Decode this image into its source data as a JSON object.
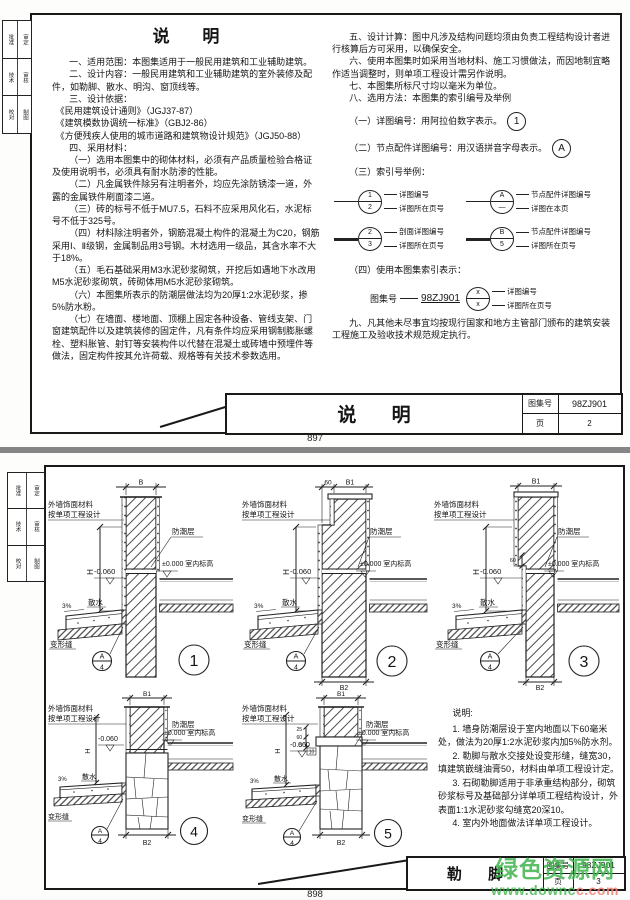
{
  "watermark": {
    "line1": "绿色资源网",
    "line2a": "www.downc",
    "line2b": "c.com",
    "green": "#3fb44d",
    "salmon": "#ef8075"
  },
  "top": {
    "page_no": "897",
    "tabs": [
      [
        "批准",
        "审定"
      ],
      [
        "技术",
        "审核"
      ],
      [
        "校对",
        "制图"
      ]
    ],
    "heading": "说  明",
    "left_paras": [
      "一、适用范围：本图集适用于一般民用建筑和工业辅助建筑。",
      "二、设计内容：一般民用建筑和工业辅助建筑的室外装修及配件，如勒脚、散水、明沟、窗顶线等。",
      "三、设计依据：",
      "《民用建筑设计通则》（JGJ37-87）",
      "《建筑模数协调统一标准》（GBJ2-86）",
      "《方便残疾人使用的城市道路和建筑物设计规范》（JGJ50-88）",
      "四、采用材料：",
      "（一）选用本图集中的砌体材料，必须有产品质量检验合格证及使用说明书，必须具有耐水防渗的性能。",
      "（二）凡金属铁件除另有注明者外，均应先涂防锈漆一道，外露的金属铁件刷面漆二道。",
      "（三）砖的标号不低于MU7.5，石料不应采用风化石，水泥标号不低于325号。",
      "（四）材料除注明者外，钢筋混凝土构件的混凝土为C20，钢筋采用Ⅰ、Ⅱ级钢，金属制品用3号钢。木材选用一级品，其含水率不大于18%。",
      "（五）毛石基础采用M3水泥砂浆砌筑，开挖后如遇地下水改用M5水泥砂浆砌筑，砖砌体用M5水泥砂浆砌筑。",
      "（六）本图集所表示的防潮层做法均为20厚1:2水泥砂浆，掺5%防水粉。",
      "（七）在墙面、楼地面、顶棚上固定各种设备、管线支架、门窗建筑配件以及建筑装修的固定件，凡有条件均应采用钢制膨胀螺栓、塑料胀管、射钉等安装构件以代替在混凝土或砖墙中预埋件等做法，固定构件按其允许荷载、规格等有关技术参数选用。"
    ],
    "right_paras": [
      "五、设计计算：图中凡涉及结构问题均须由负责工程结构设计者进行核算后方可采用，以确保安全。",
      "六、使用本图集时如采用当地材料、施工习惯做法，而因地制宜略作适当调整时，则单项工程设计需另作说明。",
      "七、本图集所标尺寸均以毫米为单位。",
      "八、选用方法：本图集的索引编号及举例",
      "（一）详图编号：用阿拉伯数字表示。",
      "（二）节点配件详图编号：用汉语拼音字母表示。",
      "（三）索引号举例："
    ],
    "c1": "1",
    "c2": "A",
    "idx": {
      "a_top": "1",
      "a_bot": "2",
      "a1": "详图编号",
      "a2": "详图所在页号",
      "b_top": "A",
      "b_bot": "—",
      "b1": "节点配件详图编号",
      "b2": "详图在本页",
      "c_top": "2",
      "c_bot": "3",
      "c1": "剖面详图编号",
      "c2": "详图所在页号",
      "d_top": "B",
      "d_bot": "5",
      "d1": "节点配件详图编号",
      "d2": "详图所在页号"
    },
    "four": "（四）使用本图集索引表示：",
    "cat_line": {
      "label": "图集号",
      "no": "98ZJ901",
      "x1": "x",
      "x2": "x",
      "l1": "详图编号",
      "l2": "详图所在页号"
    },
    "nine": "九、凡其他未尽事宜均按现行国家和地方主管部门颁布的建筑安装工程施工及验收技术规范规定执行。",
    "footer": {
      "title": "说  明",
      "cat_label": "图集号",
      "cat_no": "98ZJ901",
      "page_label": "页",
      "page_no": "2"
    }
  },
  "bottom": {
    "page_no": "898",
    "tabs": [
      [
        "批准",
        "审定"
      ],
      [
        "技术",
        "审核"
      ],
      [
        "校对",
        "制图"
      ]
    ],
    "labels": {
      "facade1": "外墙饰面材料",
      "facade2": "按单项工程设计",
      "dpc": "防潮层",
      "indoor": "±0.000 室内标高",
      "minus": "-0.060",
      "H": "H",
      "slope": "3%",
      "apron": "散水",
      "joint": "变形缝",
      "ref_top": "A",
      "ref_bot": "4"
    },
    "details": [
      {
        "no": "1",
        "top_dim": "B"
      },
      {
        "no": "2",
        "top_dim": "B1",
        "top_dim_left": "60",
        "bottom_dim": "B2"
      },
      {
        "no": "3",
        "top_dim": "B1",
        "step_dim": "60",
        "bottom_dim": "B2"
      },
      {
        "no": "4",
        "top_dim": "B1",
        "bottom_dim": "B2"
      },
      {
        "no": "5",
        "top_dim": "B1",
        "bottom_dim": "B2",
        "step_dim": "60",
        "d25": "25",
        "d60": "60",
        "d5": "5",
        "d10": "10"
      }
    ],
    "notes": {
      "heading": "说明:",
      "items": [
        "1. 墙身防潮层设于室内地面以下60毫米处，做法为20厚1:2水泥砂浆内加5%防水剂。",
        "2. 勒脚与散水交接处设变形缝，缝宽30，填建筑嵌缝油膏50，材料由单项工程设计定。",
        "3. 石砌勒脚适用于非承重结构部分，砌筑砂浆标号及基础部分详单项工程结构设计，外表面1:1水泥砂浆勾缝宽20深10。",
        "4. 室内外地面做法详单项工程设计。"
      ]
    },
    "footer": {
      "title": "勒  脚",
      "cat_label": "图集号",
      "cat_no": "98ZJ901",
      "page_label": "页",
      "page_no": "3"
    }
  }
}
